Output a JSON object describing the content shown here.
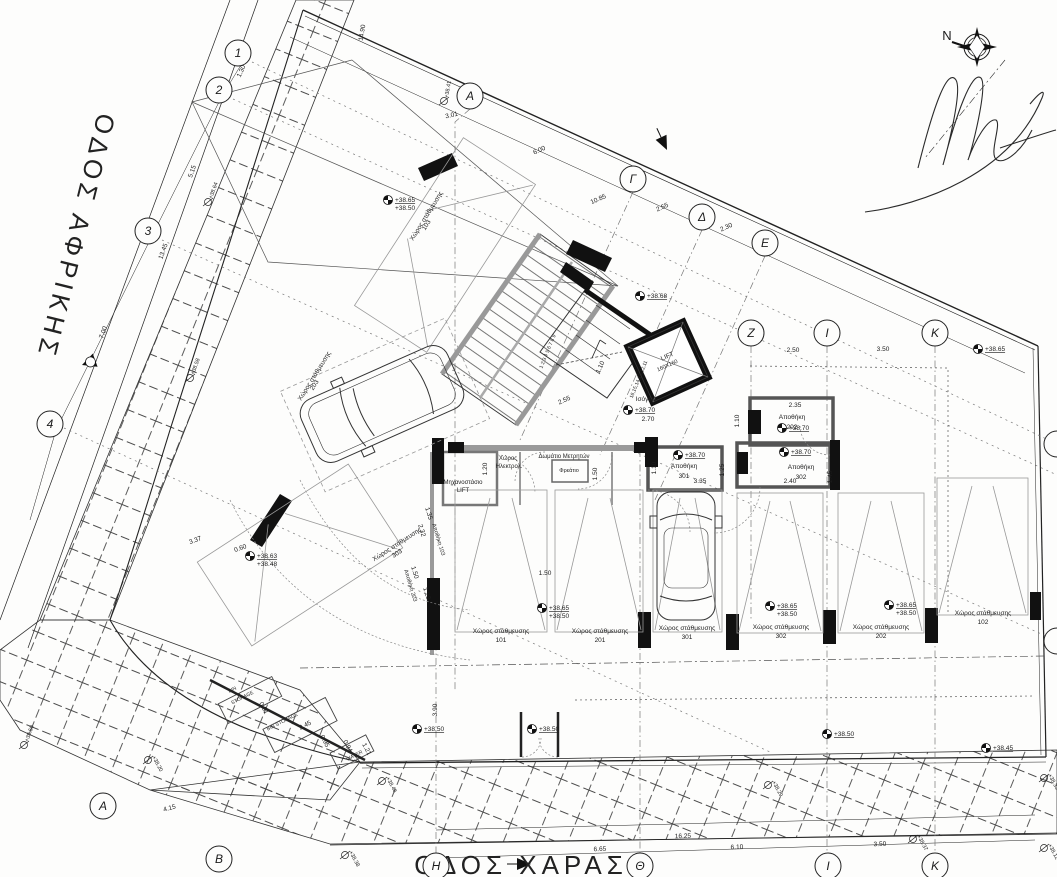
{
  "drawing": {
    "type": "architectural ground floor / parking plan",
    "streets": {
      "left": "ΟΔΟΣ ΑΦΡΙΚΗΣ",
      "bottom": "ΟΔΟΣ ΧΑΡΑΣ"
    },
    "north_label": "N",
    "grid_bubbles": [
      {
        "l": "1",
        "x": 238,
        "y": 53
      },
      {
        "l": "2",
        "x": 219,
        "y": 90
      },
      {
        "l": "3",
        "x": 148,
        "y": 231
      },
      {
        "l": "4",
        "x": 50,
        "y": 424
      },
      {
        "l": "Α",
        "x": 470,
        "y": 96
      },
      {
        "l": "Γ",
        "x": 633,
        "y": 179
      },
      {
        "l": "Δ",
        "x": 702,
        "y": 217
      },
      {
        "l": "Ε",
        "x": 765,
        "y": 243
      },
      {
        "l": "Ζ",
        "x": 751,
        "y": 333
      },
      {
        "l": "Ι",
        "x": 827,
        "y": 333
      },
      {
        "l": "Κ",
        "x": 935,
        "y": 333
      },
      {
        "l": "Η",
        "x": 436,
        "y": 866
      },
      {
        "l": "Θ",
        "x": 640,
        "y": 866
      },
      {
        "l": "Ι",
        "x": 828,
        "y": 866
      },
      {
        "l": "Κ",
        "x": 935,
        "y": 866
      },
      {
        "l": "Α",
        "x": 103,
        "y": 806
      },
      {
        "l": "Β",
        "x": 219,
        "y": 859
      },
      {
        "l": "",
        "x": 1057,
        "y": 444
      },
      {
        "l": "",
        "x": 1057,
        "y": 641
      }
    ],
    "dimensions": [
      {
        "t": "1.30",
        "x": 243,
        "y": 72,
        "r": -66
      },
      {
        "t": "5.15",
        "x": 194,
        "y": 172,
        "r": -70
      },
      {
        "t": "13.45",
        "x": 165,
        "y": 252,
        "r": -70
      },
      {
        "t": "7.00",
        "x": 105,
        "y": 333,
        "r": -70
      },
      {
        "t": "14.90",
        "x": 364,
        "y": 33,
        "r": -80
      },
      {
        "t": "3.01",
        "x": 452,
        "y": 117,
        "r": -12
      },
      {
        "t": "6.00",
        "x": 540,
        "y": 152,
        "r": -24
      },
      {
        "t": "10.85",
        "x": 599,
        "y": 201,
        "r": -24
      },
      {
        "t": "2.55",
        "x": 663,
        "y": 209,
        "r": -24
      },
      {
        "t": "2.30",
        "x": 727,
        "y": 229,
        "r": -24
      },
      {
        "t": "2.50",
        "x": 793,
        "y": 352,
        "r": 0
      },
      {
        "t": "3.50",
        "x": 883,
        "y": 351,
        "r": 0
      },
      {
        "t": "2.35",
        "x": 795,
        "y": 407,
        "r": 0
      },
      {
        "t": "1.10",
        "x": 739,
        "y": 421,
        "r": -90
      },
      {
        "t": "1.10",
        "x": 656,
        "y": 468,
        "r": -90
      },
      {
        "t": "1.25",
        "x": 724,
        "y": 470,
        "r": -90
      },
      {
        "t": "3.35",
        "x": 700,
        "y": 483,
        "r": 0
      },
      {
        "t": "2.40",
        "x": 790,
        "y": 483,
        "r": 0
      },
      {
        "t": "1.45",
        "x": 832,
        "y": 477,
        "r": -90
      },
      {
        "t": "1.50",
        "x": 597,
        "y": 474,
        "r": -90
      },
      {
        "t": "1.20",
        "x": 487,
        "y": 469,
        "r": -90
      },
      {
        "t": "2.55",
        "x": 565,
        "y": 402,
        "r": -24
      },
      {
        "t": "2.70",
        "x": 648,
        "y": 421,
        "r": 0
      },
      {
        "t": "1.10",
        "x": 602,
        "y": 368,
        "r": -65
      },
      {
        "t": "1.50",
        "x": 545,
        "y": 575,
        "r": 0
      },
      {
        "t": "3.37",
        "x": 196,
        "y": 542,
        "r": -20
      },
      {
        "t": "0.60",
        "x": 241,
        "y": 550,
        "r": -20
      },
      {
        "t": "1.35",
        "x": 427,
        "y": 514,
        "r": 73
      },
      {
        "t": "2.32",
        "x": 420,
        "y": 531,
        "r": 73
      },
      {
        "t": "1.50",
        "x": 413,
        "y": 573,
        "r": 73
      },
      {
        "t": "1.23",
        "x": 425,
        "y": 594,
        "r": 73
      },
      {
        "t": "2.45",
        "x": 306,
        "y": 727,
        "r": -27
      },
      {
        "t": "0.91",
        "x": 262,
        "y": 709,
        "r": 62
      },
      {
        "t": "0.95",
        "x": 323,
        "y": 742,
        "r": 62
      },
      {
        "t": "0.94",
        "x": 346,
        "y": 747,
        "r": 62
      },
      {
        "t": "1.21",
        "x": 365,
        "y": 750,
        "r": 62
      },
      {
        "t": "3.90",
        "x": 437,
        "y": 710,
        "r": -90
      },
      {
        "t": "4.15",
        "x": 170,
        "y": 810,
        "r": -15
      },
      {
        "t": "6.65",
        "x": 600,
        "y": 851,
        "r": -2
      },
      {
        "t": "16.25",
        "x": 683,
        "y": 838,
        "r": -2
      },
      {
        "t": "6.10",
        "x": 737,
        "y": 849,
        "r": -2
      },
      {
        "t": "3.50",
        "x": 880,
        "y": 846,
        "r": -2
      }
    ],
    "benchmarks": [
      {
        "lines": [
          "+38.68"
        ],
        "x": 640,
        "y": 296
      },
      {
        "lines": [
          "+38.70"
        ],
        "x": 628,
        "y": 410
      },
      {
        "lines": [
          "+38.70"
        ],
        "x": 782,
        "y": 428
      },
      {
        "lines": [
          "+38.70"
        ],
        "x": 678,
        "y": 455
      },
      {
        "lines": [
          "+38.70"
        ],
        "x": 784,
        "y": 452
      },
      {
        "lines": [
          "+38.65"
        ],
        "x": 978,
        "y": 349
      },
      {
        "lines": [
          "+38.65",
          "+38.50"
        ],
        "x": 542,
        "y": 608
      },
      {
        "lines": [
          "+38.65",
          "+38.50"
        ],
        "x": 770,
        "y": 606
      },
      {
        "lines": [
          "+38.65",
          "+38.50"
        ],
        "x": 889,
        "y": 605
      },
      {
        "lines": [
          "+38.63",
          "+38.48"
        ],
        "x": 250,
        "y": 556
      },
      {
        "lines": [
          "+38.65",
          "+38.50"
        ],
        "x": 388,
        "y": 200
      },
      {
        "lines": [
          "+38.50"
        ],
        "x": 417,
        "y": 729
      },
      {
        "lines": [
          "+38.50"
        ],
        "x": 532,
        "y": 729
      },
      {
        "lines": [
          "+38.50"
        ],
        "x": 827,
        "y": 734
      },
      {
        "lines": [
          "+38.45"
        ],
        "x": 986,
        "y": 748
      }
    ],
    "spot_levels": [
      {
        "t": "+38.41",
        "x": 444,
        "y": 98,
        "r": -80
      },
      {
        "t": "+38.64",
        "x": 208,
        "y": 199,
        "r": -70
      },
      {
        "t": "+38.58",
        "x": 190,
        "y": 375,
        "r": -70
      },
      {
        "t": "+38.50",
        "x": 24,
        "y": 742,
        "r": -70
      },
      {
        "t": "+38.20",
        "x": 148,
        "y": 757,
        "r": 62
      },
      {
        "t": "+38.38",
        "x": 345,
        "y": 852,
        "r": 62
      },
      {
        "t": "+38.46",
        "x": 382,
        "y": 778,
        "r": 62
      },
      {
        "t": "+38.29",
        "x": 768,
        "y": 782,
        "r": 62
      },
      {
        "t": "+38.37",
        "x": 913,
        "y": 836,
        "r": 62
      },
      {
        "t": "+38.12",
        "x": 1044,
        "y": 845,
        "r": 62
      },
      {
        "t": "+38.33",
        "x": 1044,
        "y": 775,
        "r": 62
      }
    ],
    "parking_label": "Χώρος στάθμευσης",
    "parking_spaces": [
      {
        "num": "101",
        "x": 501,
        "y": 633,
        "r": 0
      },
      {
        "num": "201",
        "x": 600,
        "y": 633,
        "r": 0
      },
      {
        "num": "301",
        "x": 687,
        "y": 630,
        "r": 0
      },
      {
        "num": "302",
        "x": 781,
        "y": 629,
        "r": 0
      },
      {
        "num": "202",
        "x": 881,
        "y": 629,
        "r": 0
      },
      {
        "num": "102",
        "x": 983,
        "y": 615,
        "r": 0
      },
      {
        "num": "303",
        "x": 398,
        "y": 546,
        "r": -33
      },
      {
        "num": "203",
        "x": 316,
        "y": 377,
        "r": -58
      },
      {
        "num": "103",
        "x": 428,
        "y": 217,
        "r": -58
      }
    ],
    "storage_label": "Αποθήκη",
    "storages": [
      {
        "num": "202",
        "x": 792,
        "y": 419,
        "r": 0
      },
      {
        "num": "301",
        "x": 684,
        "y": 468,
        "r": 0
      },
      {
        "num": "302",
        "x": 801,
        "y": 469,
        "r": 0
      }
    ],
    "annotations": [
      {
        "t": "Μηχανοστάσιο",
        "x": 463,
        "y": 484,
        "s": 6
      },
      {
        "t": "LIFT",
        "x": 463,
        "y": 492,
        "s": 6
      },
      {
        "t": "Χώρος",
        "x": 508,
        "y": 460,
        "s": 6
      },
      {
        "t": "Ηλεκτρολ.",
        "x": 509,
        "y": 468,
        "s": 6
      },
      {
        "t": "Δωμάτιο Μετρητών",
        "x": 564,
        "y": 458,
        "s": 6
      },
      {
        "t": "Φρεάτιο",
        "x": 569,
        "y": 472,
        "s": 5.5
      },
      {
        "t": "Ισόγειο",
        "x": 646,
        "y": 401,
        "s": 6.5
      },
      {
        "t": "LIFT",
        "x": 668,
        "y": 358,
        "s": 6.5,
        "r": -24
      },
      {
        "t": "160X160",
        "x": 668,
        "y": 367,
        "s": 5.5,
        "r": -24
      },
      {
        "t": "BIN",
        "x": 233,
        "y": 691,
        "s": 5,
        "r": -27
      },
      {
        "t": "STORAGE",
        "x": 243,
        "y": 699,
        "s": 5,
        "r": -27
      },
      {
        "t": "BIN STORAGE",
        "x": 283,
        "y": 723,
        "s": 5,
        "r": -27
      },
      {
        "t": "WATER",
        "x": 355,
        "y": 757,
        "s": 5,
        "r": -27
      },
      {
        "t": "16,15,14,13,12,11",
        "x": 640,
        "y": 380,
        "s": 5,
        "r": -68
      },
      {
        "t": "1 2 3 4 5 6 7 8 9",
        "x": 549,
        "y": 352,
        "s": 5,
        "r": -68
      },
      {
        "t": "Αποθήκη 103",
        "x": 437,
        "y": 540,
        "s": 5.5,
        "r": 73
      },
      {
        "t": "Αποθήκη 203",
        "x": 409,
        "y": 586,
        "s": 5.5,
        "r": 73
      }
    ]
  }
}
